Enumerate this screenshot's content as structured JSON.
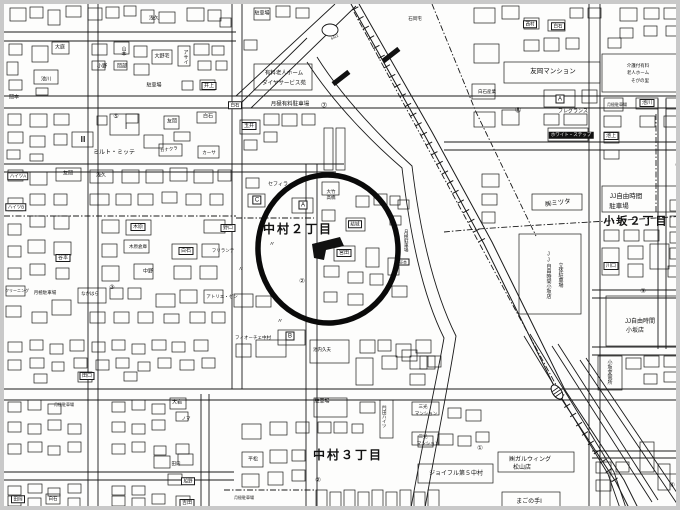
{
  "map": {
    "type": "japanese-residential-map",
    "colors": {
      "paper": "#fdfdfc",
      "frame": "#c9c9c9",
      "ink": "#1a1a1a",
      "annotation": "#0a0a0a"
    },
    "annotation_circle": {
      "cx": 324,
      "cy": 245,
      "rx": 70,
      "ry": 74,
      "stroke_width": 5.5
    },
    "districts": [
      "中村２丁目",
      "中村３丁目",
      "小坂２丁目"
    ],
    "labels": [
      {
        "t": "中村２丁目",
        "x": 294,
        "y": 225,
        "fs": 12,
        "b": 1
      },
      {
        "t": "中村３丁目",
        "x": 344,
        "y": 451,
        "fs": 12,
        "b": 1
      },
      {
        "t": "小坂２丁目",
        "x": 632,
        "y": 218,
        "fs": 11,
        "b": 1
      },
      {
        "t": "浅久",
        "x": 150,
        "y": 15,
        "fs": 5
      },
      {
        "t": "大庭",
        "x": 56,
        "y": 44,
        "fs": 5
      },
      {
        "t": "山本",
        "x": 119,
        "y": 47,
        "fs": 5,
        "v": 1
      },
      {
        "t": "小野",
        "x": 98,
        "y": 63,
        "fs": 5
      },
      {
        "t": "岡部",
        "x": 118,
        "y": 63,
        "fs": 5
      },
      {
        "t": "池川",
        "x": 42,
        "y": 76,
        "fs": 5
      },
      {
        "t": "岡本",
        "x": 10,
        "y": 94,
        "fs": 5
      },
      {
        "t": "大野宅",
        "x": 158,
        "y": 53,
        "fs": 5
      },
      {
        "t": "アサイ",
        "x": 181,
        "y": 53,
        "fs": 5,
        "v": 1
      },
      {
        "t": "駐車場",
        "x": 150,
        "y": 82,
        "fs": 5
      },
      {
        "t": "井上",
        "x": 205,
        "y": 82,
        "fs": 5,
        "box": 1
      },
      {
        "t": "白石",
        "x": 204,
        "y": 113,
        "fs": 5
      },
      {
        "t": "友岡",
        "x": 168,
        "y": 118,
        "fs": 5
      },
      {
        "t": "ミルト・ミッテ",
        "x": 110,
        "y": 149,
        "fs": 6
      },
      {
        "t": "カナクラ",
        "x": 165,
        "y": 146,
        "fs": 4.5,
        "rot": -8
      },
      {
        "t": "カーサ",
        "x": 205,
        "y": 149,
        "fs": 4.5
      },
      {
        "t": "Ⅰ",
        "x": 122,
        "y": 123,
        "fs": 8
      },
      {
        "t": "Ⅲ",
        "x": 79,
        "y": 136,
        "fs": 8
      },
      {
        "t": "⑤",
        "x": 112,
        "y": 113,
        "fs": 6
      },
      {
        "t": "ハイツA",
        "x": 14,
        "y": 172,
        "fs": 4.5,
        "box": 1
      },
      {
        "t": "ハイツB",
        "x": 12,
        "y": 203,
        "fs": 4.5,
        "box": 1
      },
      {
        "t": "駐車場",
        "x": 258,
        "y": 10,
        "fs": 5
      },
      {
        "t": "有料老人ホーム",
        "x": 280,
        "y": 70,
        "fs": 5.5
      },
      {
        "t": "ダイヤサービス苑",
        "x": 280,
        "y": 80,
        "fs": 5.5
      },
      {
        "t": "月極有料駐車場",
        "x": 286,
        "y": 101,
        "fs": 5.5
      },
      {
        "t": "⑦",
        "x": 320,
        "y": 102,
        "fs": 7
      },
      {
        "t": "白石",
        "x": 231,
        "y": 101,
        "fs": 4.5,
        "box": 1
      },
      {
        "t": "玉井",
        "x": 245,
        "y": 122,
        "fs": 5,
        "box": 1
      },
      {
        "t": "石岡宅",
        "x": 411,
        "y": 15,
        "fs": 4.5
      },
      {
        "t": "6412",
        "x": 331,
        "y": 34,
        "fs": 3.5,
        "rot": -25
      },
      {
        "t": "西村",
        "x": 526,
        "y": 20,
        "fs": 4.5,
        "box": 1
      },
      {
        "t": "白石",
        "x": 554,
        "y": 22,
        "fs": 4.5,
        "box": 1
      },
      {
        "t": "友岡マンション",
        "x": 549,
        "y": 68,
        "fs": 6.5
      },
      {
        "t": "白石産業",
        "x": 483,
        "y": 88,
        "fs": 4.5
      },
      {
        "t": "A",
        "x": 556,
        "y": 95,
        "fs": 6,
        "box": 1
      },
      {
        "t": "フレグランス",
        "x": 569,
        "y": 108,
        "fs": 5
      },
      {
        "t": "⑧",
        "x": 514,
        "y": 107,
        "fs": 7
      },
      {
        "t": "ホワイト・ステップ",
        "x": 567,
        "y": 131,
        "fs": 4.5,
        "inv": 1
      },
      {
        "t": "池上",
        "x": 607,
        "y": 132,
        "fs": 5,
        "box": 1
      },
      {
        "t": "介護付有料",
        "x": 634,
        "y": 62,
        "fs": 4.5
      },
      {
        "t": "老人ホーム",
        "x": 634,
        "y": 69,
        "fs": 4.5
      },
      {
        "t": "そがの里",
        "x": 636,
        "y": 77,
        "fs": 4.5
      },
      {
        "t": "池川",
        "x": 643,
        "y": 99,
        "fs": 5,
        "box": 1
      },
      {
        "t": "月極駐車場",
        "x": 613,
        "y": 101,
        "fs": 4
      },
      {
        "t": "友岡",
        "x": 64,
        "y": 170,
        "fs": 5
      },
      {
        "t": "浅久",
        "x": 97,
        "y": 172,
        "fs": 5
      },
      {
        "t": "木原",
        "x": 134,
        "y": 223,
        "fs": 5,
        "box": 1
      },
      {
        "t": "木原倉庫",
        "x": 134,
        "y": 243,
        "fs": 4.5
      },
      {
        "t": "中野",
        "x": 144,
        "y": 268,
        "fs": 5
      },
      {
        "t": "白石",
        "x": 182,
        "y": 247,
        "fs": 5,
        "box": 1
      },
      {
        "t": "谷本",
        "x": 59,
        "y": 254,
        "fs": 5,
        "box": 1
      },
      {
        "t": "野口",
        "x": 224,
        "y": 224,
        "fs": 5,
        "box": 1
      },
      {
        "t": "フリランテ",
        "x": 219,
        "y": 247,
        "fs": 4.5
      },
      {
        "t": "アトリエ・ゼン",
        "x": 218,
        "y": 293,
        "fs": 4.5
      },
      {
        "t": "月極駐車場",
        "x": 41,
        "y": 289,
        "fs": 4.5
      },
      {
        "t": "なかはら",
        "x": 86,
        "y": 290,
        "fs": 4.5
      },
      {
        "t": "③",
        "x": 108,
        "y": 284,
        "fs": 6
      },
      {
        "t": "クリーニング",
        "x": 13,
        "y": 287,
        "fs": 4
      },
      {
        "t": "セフィラ",
        "x": 274,
        "y": 181,
        "fs": 5
      },
      {
        "t": "C",
        "x": 253,
        "y": 196,
        "fs": 6,
        "box": 1
      },
      {
        "t": "A",
        "x": 299,
        "y": 201,
        "fs": 6,
        "box": 1
      },
      {
        "t": "大竹",
        "x": 327,
        "y": 188,
        "fs": 4.5
      },
      {
        "t": "高橋",
        "x": 327,
        "y": 194,
        "fs": 4.5
      },
      {
        "t": "結城",
        "x": 351,
        "y": 220,
        "fs": 4.5,
        "box": 1
      },
      {
        "t": "宮田",
        "x": 340,
        "y": 249,
        "fs": 5,
        "box": 1
      },
      {
        "t": "②",
        "x": 298,
        "y": 278,
        "fs": 6.5
      },
      {
        "t": "〃",
        "x": 268,
        "y": 241,
        "fs": 6
      },
      {
        "t": "〃",
        "x": 276,
        "y": 318,
        "fs": 6
      },
      {
        "t": "〃",
        "x": 237,
        "y": 266,
        "fs": 6
      },
      {
        "t": "月極駐車場",
        "x": 402,
        "y": 237,
        "fs": 4.5,
        "v": 1
      },
      {
        "t": "谷本",
        "x": 399,
        "y": 258,
        "fs": 4,
        "box": 1
      },
      {
        "t": "JJ自由時間",
        "x": 622,
        "y": 193,
        "fs": 6.5
      },
      {
        "t": "駐車場",
        "x": 615,
        "y": 203,
        "fs": 6.5
      },
      {
        "t": "㈱ミツタ",
        "x": 554,
        "y": 200,
        "fs": 6.5,
        "rot": -8
      },
      {
        "t": "JJ自由時間小坂店",
        "x": 544,
        "y": 271,
        "fs": 5,
        "v": 1
      },
      {
        "t": "立体駐車場",
        "x": 556,
        "y": 271,
        "fs": 5,
        "v": 1
      },
      {
        "t": "川口",
        "x": 607,
        "y": 262,
        "fs": 5,
        "box": 1
      },
      {
        "t": "③",
        "x": 639,
        "y": 288,
        "fs": 6.5
      },
      {
        "t": "JJ自由時間",
        "x": 636,
        "y": 318,
        "fs": 6
      },
      {
        "t": "小坂店",
        "x": 631,
        "y": 327,
        "fs": 6
      },
      {
        "t": "④",
        "x": 674,
        "y": 162,
        "fs": 6.5
      },
      {
        "t": "フィオーチェ中村",
        "x": 249,
        "y": 334,
        "fs": 4.5
      },
      {
        "t": "B",
        "x": 286,
        "y": 332,
        "fs": 6,
        "box": 1
      },
      {
        "t": "池内久夫",
        "x": 318,
        "y": 346,
        "fs": 4.5
      },
      {
        "t": "駐車場",
        "x": 318,
        "y": 398,
        "fs": 5
      },
      {
        "t": "門田ハイツ",
        "x": 380,
        "y": 413,
        "fs": 4.5,
        "v": 1
      },
      {
        "t": "②",
        "x": 314,
        "y": 477,
        "fs": 6.5
      },
      {
        "t": "平松",
        "x": 249,
        "y": 456,
        "fs": 5
      },
      {
        "t": "月極駐車場",
        "x": 240,
        "y": 494,
        "fs": 4
      },
      {
        "t": "三光",
        "x": 419,
        "y": 403,
        "fs": 4.5
      },
      {
        "t": "マンション",
        "x": 422,
        "y": 410,
        "fs": 4.5
      },
      {
        "t": "三光",
        "x": 419,
        "y": 433,
        "fs": 4.5
      },
      {
        "t": "マンション",
        "x": 424,
        "y": 440,
        "fs": 4.5
      },
      {
        "t": "ジョイフル第５中村",
        "x": 452,
        "y": 470,
        "fs": 6
      },
      {
        "t": "㈱ガルウィング",
        "x": 526,
        "y": 456,
        "fs": 6
      },
      {
        "t": "松山店",
        "x": 518,
        "y": 464,
        "fs": 6
      },
      {
        "t": "まごの手Ⅰ",
        "x": 525,
        "y": 498,
        "fs": 6
      },
      {
        "t": "①",
        "x": 476,
        "y": 445,
        "fs": 6.5
      },
      {
        "t": "小坂変電所",
        "x": 605,
        "y": 368,
        "fs": 5,
        "v": 1
      },
      {
        "t": "④",
        "x": 668,
        "y": 482,
        "fs": 6.5
      },
      {
        "t": "吉田",
        "x": 183,
        "y": 499,
        "fs": 5,
        "box": 1
      },
      {
        "t": "田口",
        "x": 83,
        "y": 372,
        "fs": 5,
        "box": 1
      },
      {
        "t": "大岩",
        "x": 173,
        "y": 399,
        "fs": 5
      },
      {
        "t": "ノマ",
        "x": 182,
        "y": 415,
        "fs": 4.5
      },
      {
        "t": "船野",
        "x": 184,
        "y": 477,
        "fs": 4.5,
        "box": 1
      },
      {
        "t": "田内",
        "x": 172,
        "y": 460,
        "fs": 4.5
      },
      {
        "t": "月極駐車場",
        "x": 60,
        "y": 401,
        "fs": 4
      },
      {
        "t": "白石",
        "x": 49,
        "y": 495,
        "fs": 4.5
      },
      {
        "t": "田岡",
        "x": 14,
        "y": 495,
        "fs": 4.5,
        "box": 1
      }
    ]
  }
}
